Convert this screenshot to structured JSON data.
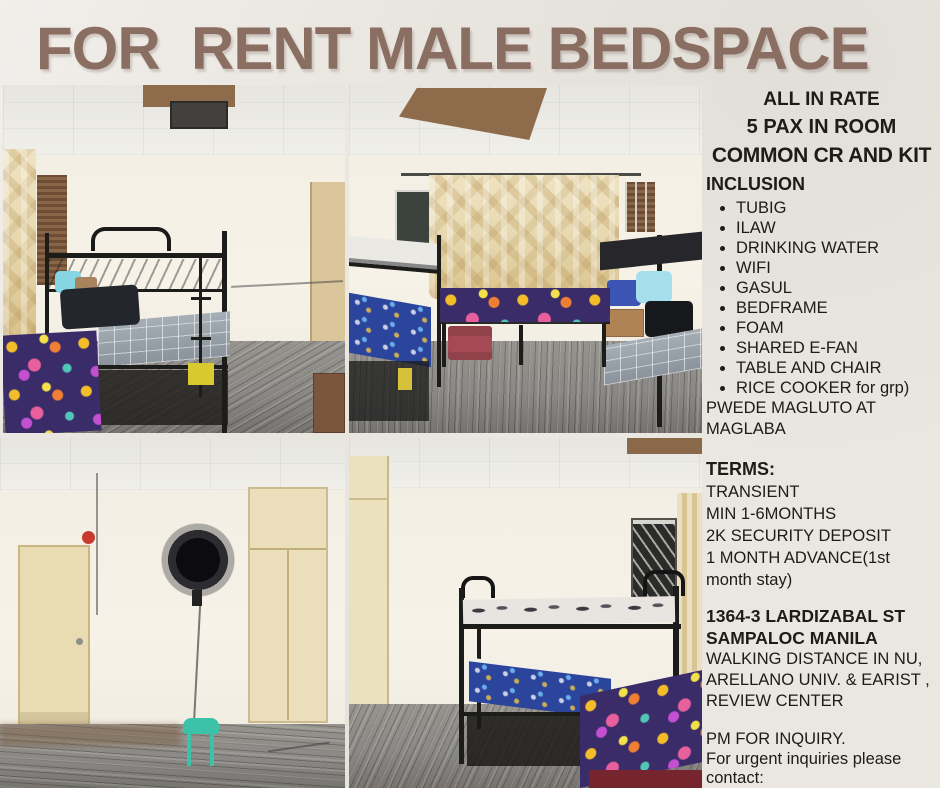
{
  "title": "FOR  RENT MALE BEDSPACE",
  "colors": {
    "paper": "#eae6e0",
    "title": "#8a6e62",
    "ink": "#1e1b18",
    "floor": "#8b8985",
    "curtain": "#e6d7ae",
    "floral": "#392c68",
    "stool": "#3cc2a9",
    "patch": "#8d6b4b",
    "cream": "#eadfba",
    "frame": "#1c1c1a"
  },
  "details": {
    "header_lines": [
      "ALL IN RATE",
      "5 PAX IN ROOM",
      "COMMON CR AND KIT"
    ],
    "inclusion": {
      "heading": "INCLUSION",
      "items": [
        "TUBIG",
        "ILAW",
        "DRINKING WATER",
        "WIFI",
        "GASUL",
        "BEDFRAME",
        "FOAM",
        "SHARED E-FAN",
        "TABLE AND CHAIR",
        "RICE COOKER for grp)"
      ],
      "note": "PWEDE MAGLUTO AT MAGLABA"
    },
    "terms": {
      "heading": "TERMS:",
      "lines": [
        "TRANSIENT",
        "MIN 1-6MONTHS",
        "2K SECURITY DEPOSIT",
        "1 MONTH ADVANCE(1st month stay)"
      ]
    },
    "location": {
      "address_lines": [
        "1364-3 LARDIZABAL ST",
        "SAMPALOC MANILA"
      ],
      "lines": [
        "WALKING DISTANCE IN NU,",
        "ARELLANO UNIV. & EARIST ,",
        "REVIEW CENTER"
      ]
    },
    "contact": {
      "lines": [
        "PM FOR INQUIRY.",
        "For urgent inquiries please contact:"
      ]
    }
  },
  "photos": {
    "top_left": "room with black bunk bed, plaid and floral mattresses, blinds and cabinet",
    "top_right": "room with two bunk beds and gold curtains over the window",
    "bottom_left": "empty room with cream door, wall fan, green stool and built-in cabinets",
    "bottom_right": "room with black bunk bed, floral mattress and barred window"
  }
}
